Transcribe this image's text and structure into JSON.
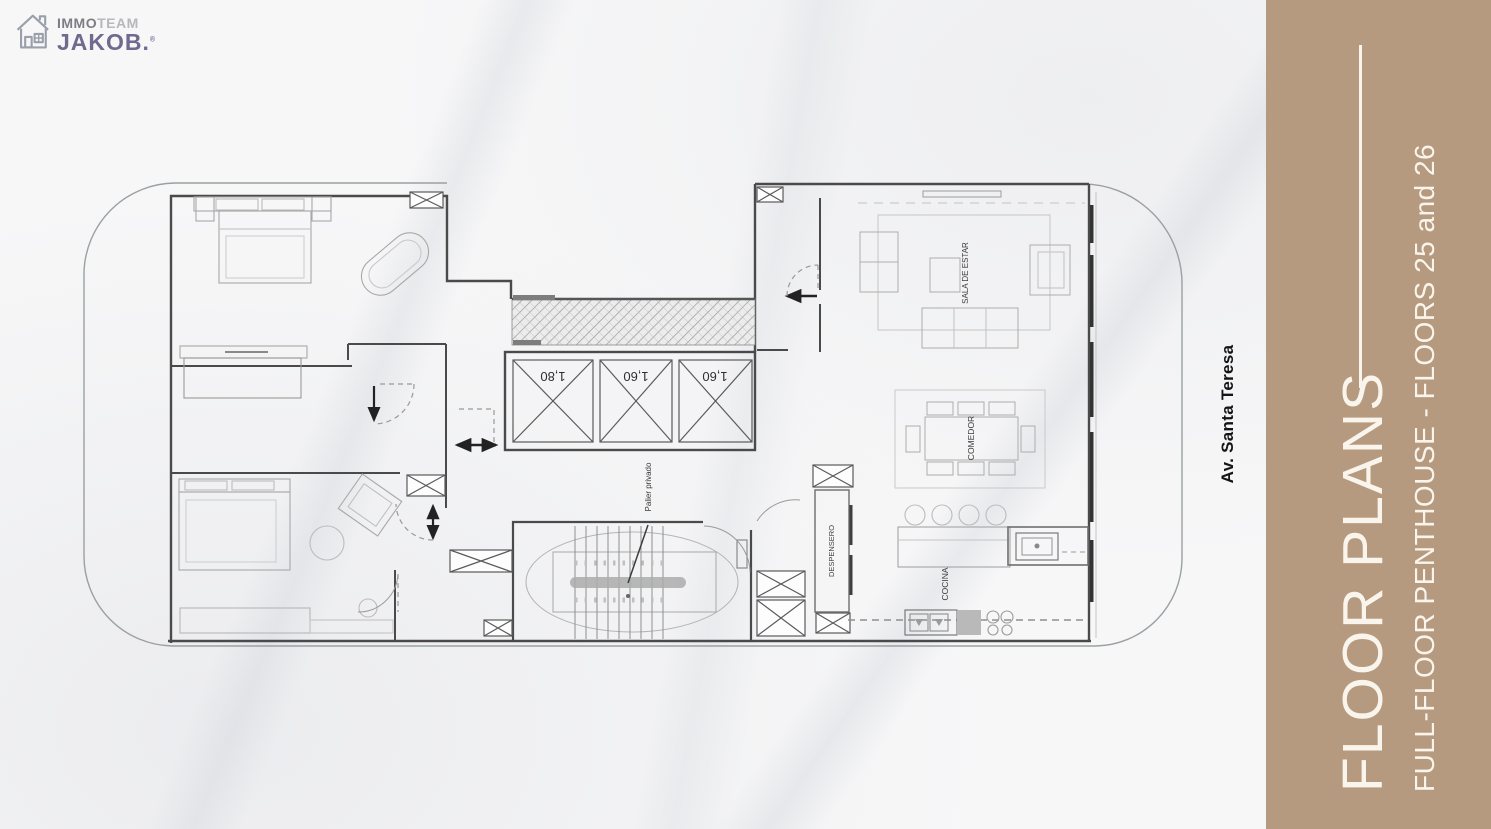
{
  "slide": {
    "logo": {
      "brand_line1_part1": "IMMO",
      "brand_line1_part2": "TEAM",
      "brand_line2": "JAKOB.",
      "registered": "®"
    },
    "street_label": "Av. Santa Teresa",
    "sidebar": {
      "title": "FLOOR PLANS",
      "subtitle": "FULL-FLOOR PENTHOUSE - FLOORS 25 and 26",
      "bg_color": "#b59a7f",
      "text_color": "#faf5ec"
    },
    "floor_plan": {
      "labels": {
        "sala": "SALA DE ESTAR",
        "comedor": "COMEDOR",
        "cocina": "COCINA",
        "despensero": "DESPENSERO",
        "palier": "Palier privado"
      },
      "elevators": [
        {
          "label": "1,80"
        },
        {
          "label": "1,60"
        },
        {
          "label": "1,60"
        }
      ]
    }
  }
}
